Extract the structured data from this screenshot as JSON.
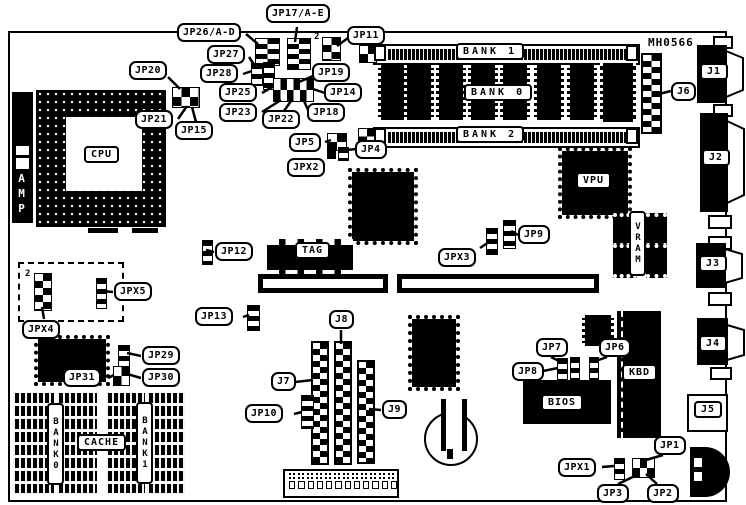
{
  "board": {
    "part_number": "MH0566",
    "pin2_marker": "2"
  },
  "chips": {
    "cpu": "CPU",
    "amp": "AMP",
    "vpu": "VPU",
    "vram": "VRAM",
    "tag": "TAG",
    "bios": "BIOS",
    "kbd": "KBD",
    "cache": "CACHE",
    "cache_bank0": "BANK0",
    "cache_bank1": "BANK1"
  },
  "memory_banks": {
    "bank0": "BANK 0",
    "bank1": "BANK 1",
    "bank2": "BANK 2"
  },
  "connectors": {
    "j1": "J1",
    "j2": "J2",
    "j3": "J3",
    "j4": "J4",
    "j5": "J5",
    "j6": "J6",
    "j7": "J7",
    "j8": "J8",
    "j9": "J9"
  },
  "jumpers": {
    "jp1": "JP1",
    "jp2": "JP2",
    "jp3": "JP3",
    "jp4": "JP4",
    "jp5": "JP5",
    "jp6": "JP6",
    "jp7": "JP7",
    "jp8": "JP8",
    "jp9": "JP9",
    "jp10": "JP10",
    "jp11": "JP11",
    "jp12": "JP12",
    "jp13": "JP13",
    "jp14": "JP14",
    "jp15": "JP15",
    "jp17": "JP17/A-E",
    "jp18": "JP18",
    "jp19": "JP19",
    "jp20": "JP20",
    "jp21": "JP21",
    "jp22": "JP22",
    "jp23": "JP23",
    "jp25": "JP25",
    "jp26": "JP26/A-D",
    "jp27": "JP27",
    "jp28": "JP28",
    "jp29": "JP29",
    "jp30": "JP30",
    "jp31": "JP31",
    "jpx1": "JPX1",
    "jpx2": "JPX2",
    "jpx3": "JPX3",
    "jpx4": "JPX4",
    "jpx5": "JPX5"
  }
}
